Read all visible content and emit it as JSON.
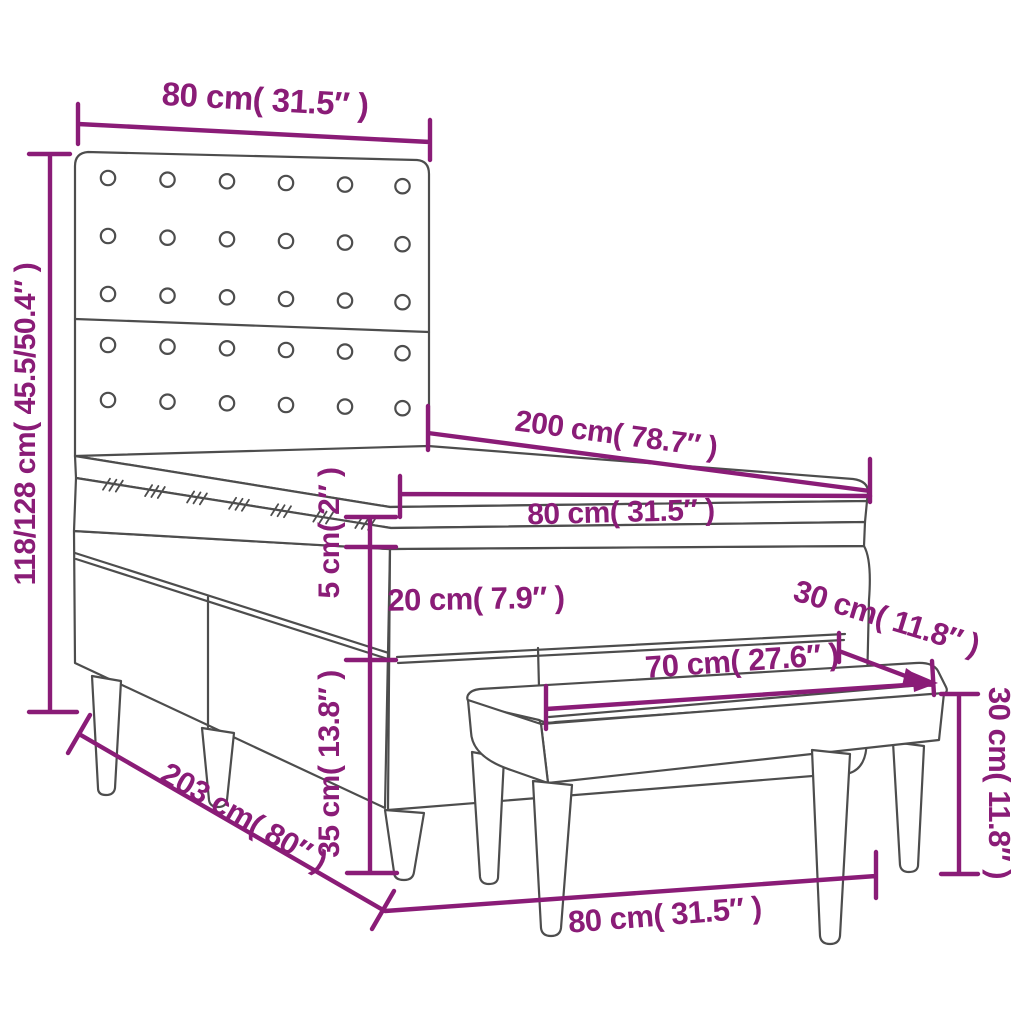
{
  "diagram": {
    "title": "Box spring bed with headboard, mattress topper and bench - dimension drawing",
    "colors": {
      "dimension_line": "#8A1C77",
      "drawing_line": "#4d4d4d",
      "background": "#ffffff"
    },
    "headboard_buttons": {
      "columns": 6,
      "rows_upper_panel": 3,
      "rows_lower_panel": 2
    },
    "dimensions": {
      "headboard_width": "80 cm( 31.5″ )",
      "headboard_height": "118/128 cm( 45.5/50.4″ )",
      "mattress_length": "200 cm( 78.7″ )",
      "mattress_width": "80 cm( 31.5″ )",
      "topper_height": "5 cm( 2″ )",
      "boxspring_height": "20 cm( 7.9″ )",
      "base_height": "35 cm( 13.8″ )",
      "bed_total_length": "203 cm( 80″ )",
      "bed_total_width": "80 cm( 31.5″ )",
      "bench_length": "70 cm( 27.6″ )",
      "bench_depth": "30 cm( 11.8″ )",
      "bench_height": "30 cm( 11.8″ )"
    }
  }
}
